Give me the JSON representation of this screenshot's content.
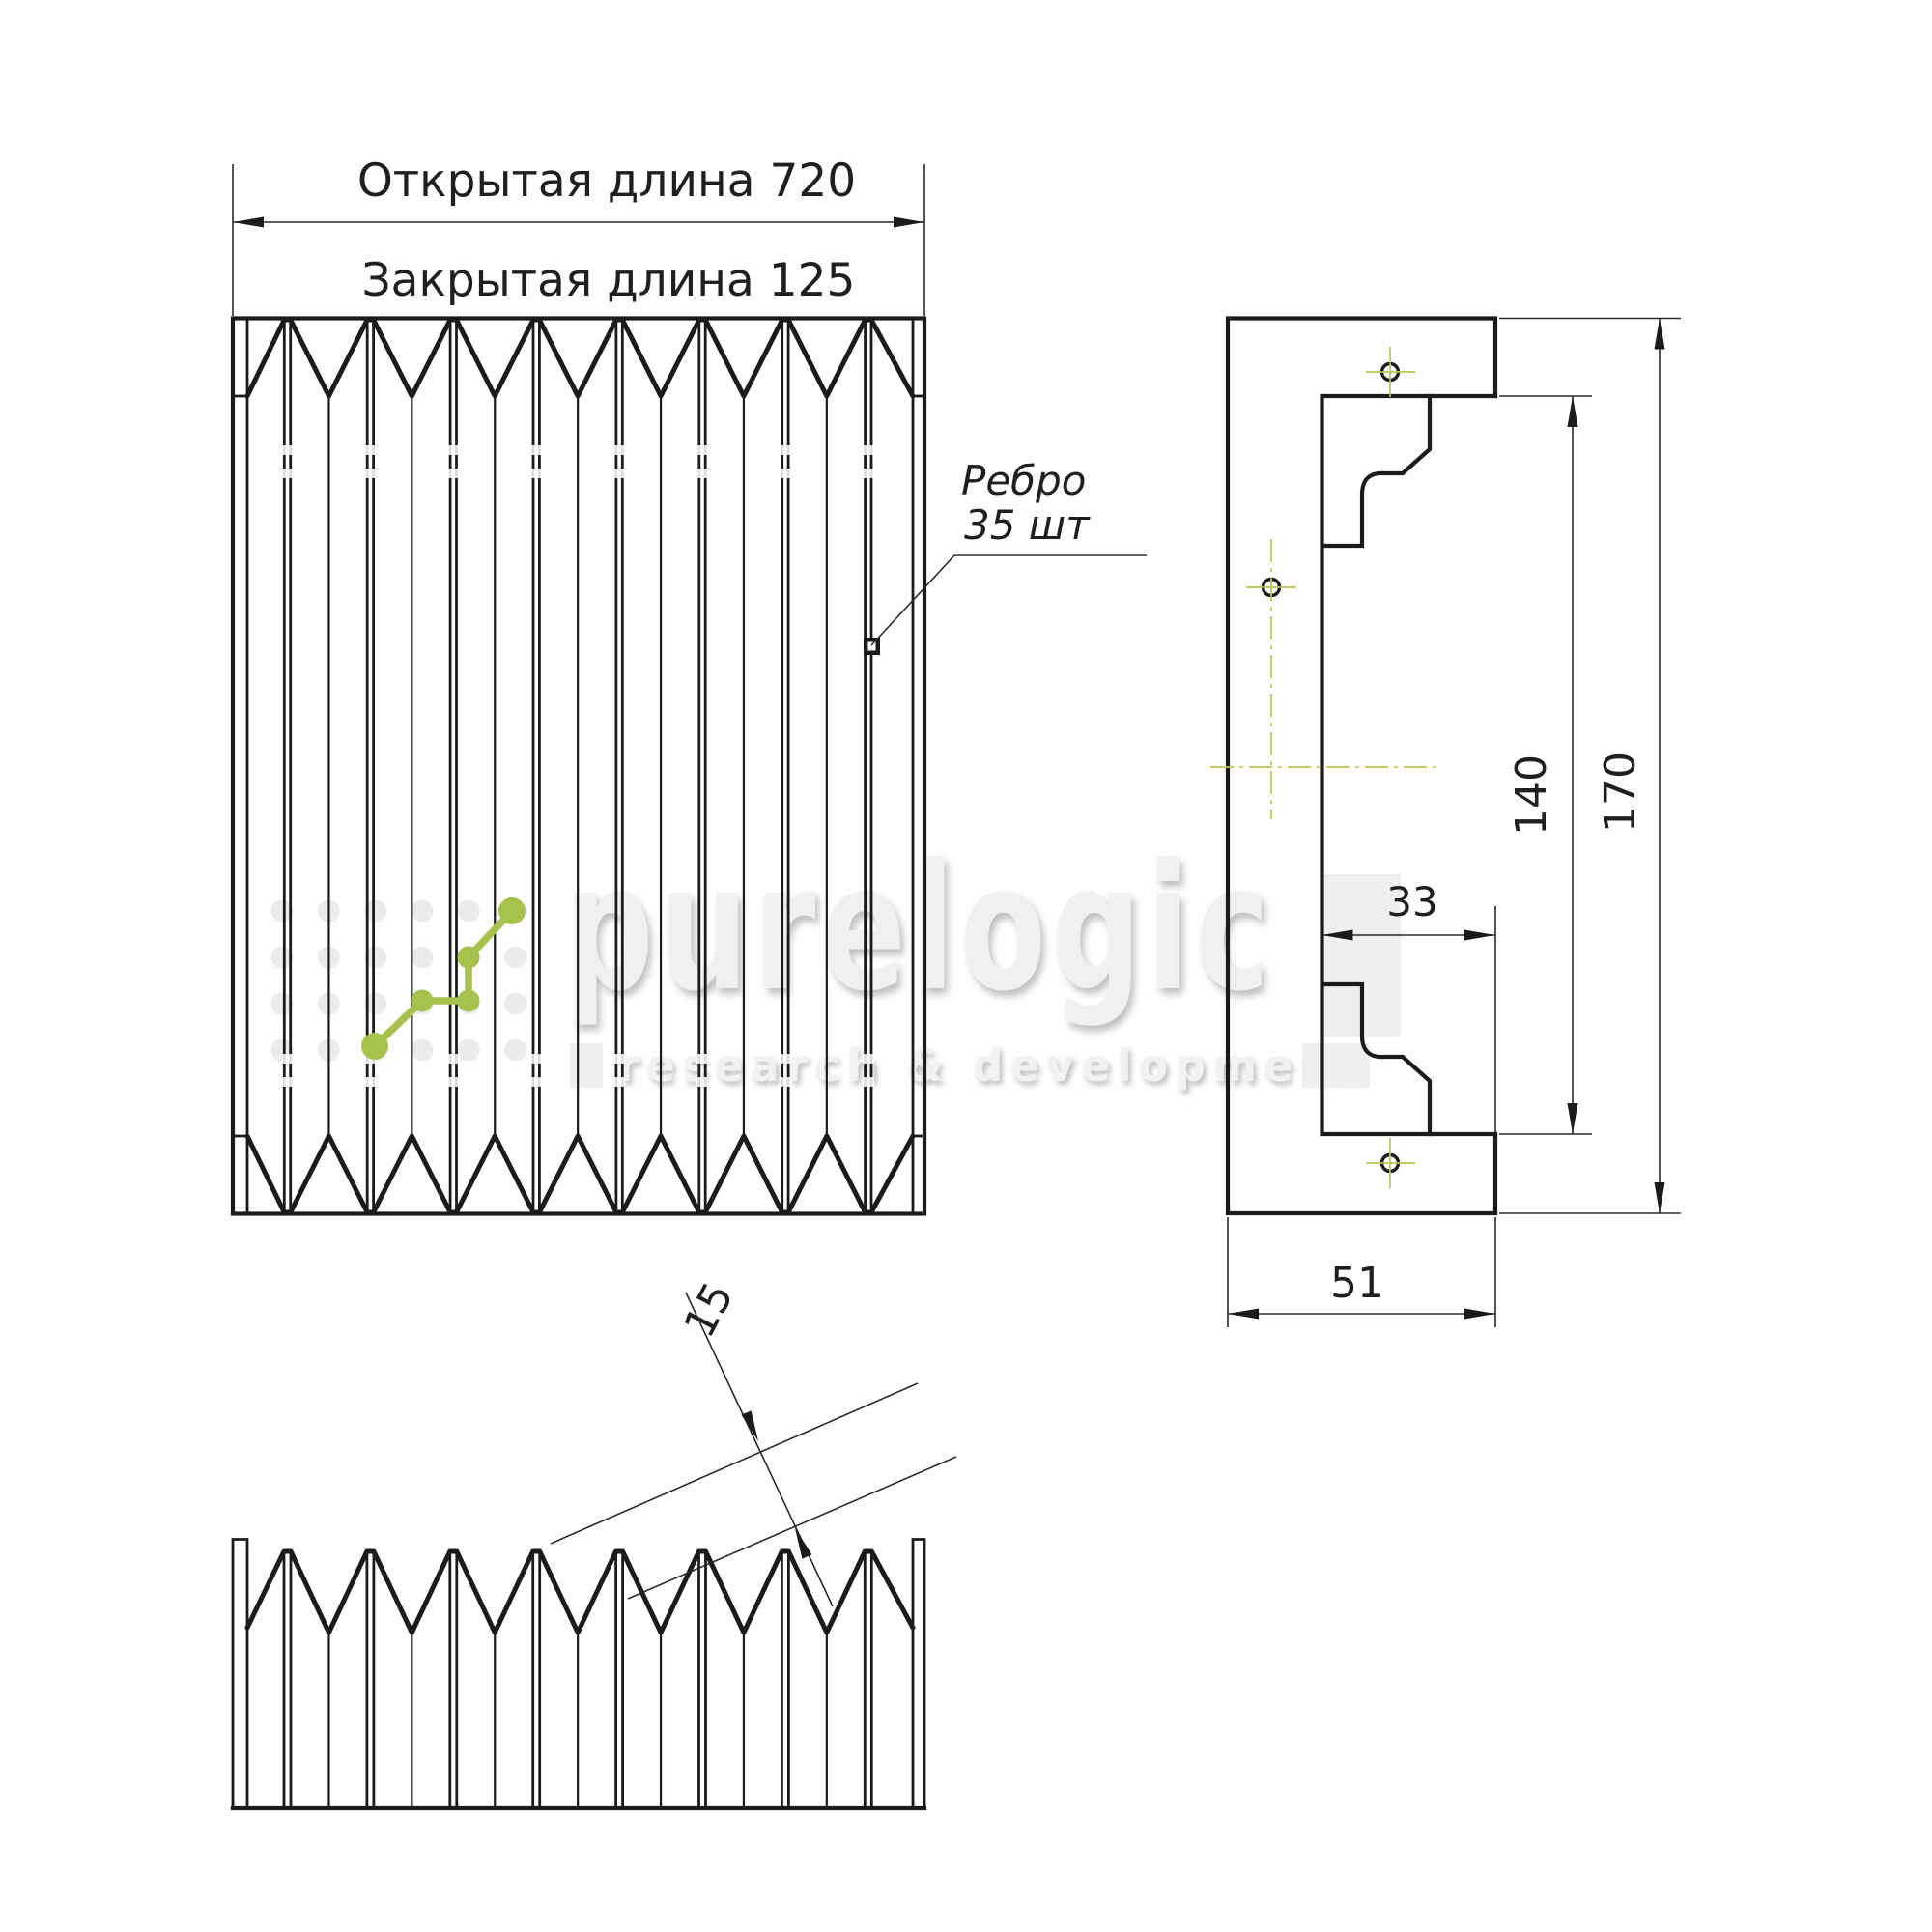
{
  "drawing": {
    "front_view": {
      "open_length_label": "Открытая длина 720",
      "closed_length_label": "Закрытая длина 125",
      "open_length_value": "720",
      "closed_length_value": "125",
      "rib_note_line1": "Ребро",
      "rib_note_line2": "35 шт",
      "rib_count": "35"
    },
    "side_view": {
      "inner_height": "140",
      "outer_height": "170",
      "flange_depth": "33",
      "profile_width": "51"
    },
    "top_view": {
      "pleat_pitch": "15"
    }
  },
  "watermark": {
    "brand": "purelogic",
    "tagline": "research & development"
  },
  "colors": {
    "line": "#1b1b1b",
    "thin_line": "#2a2a2a",
    "accent_green": "#a6c24c",
    "centerline_green": "#b5c94e",
    "watermark_gray": "#efefef"
  }
}
